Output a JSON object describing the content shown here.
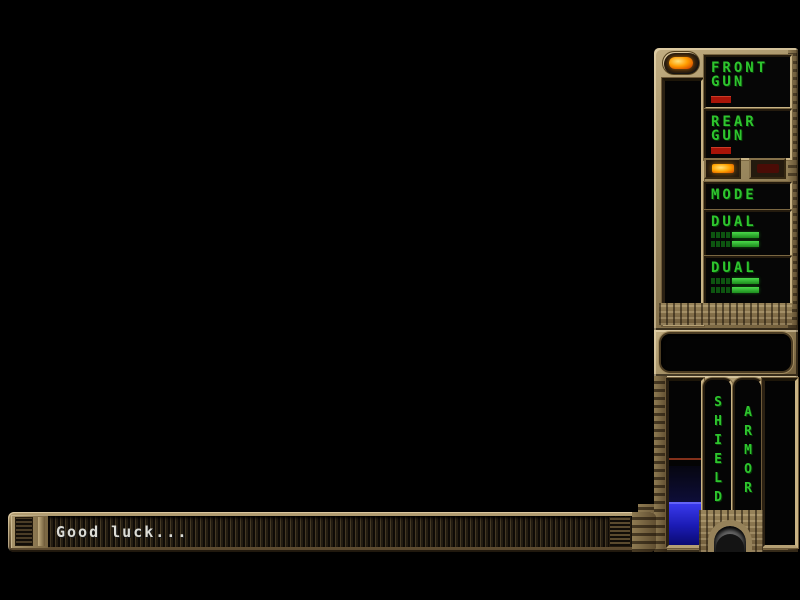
{
  "window": {
    "width": 800,
    "height": 600
  },
  "sidebar": {
    "weapon_panel": {
      "power_led": "on",
      "energy_fill_pct": 8,
      "front_gun": {
        "line1": "FRONT",
        "line2": "GUN",
        "power_pct": 24
      },
      "rear_gun": {
        "line1": "REAR",
        "line2": "GUN",
        "power_pct": 24
      },
      "mode": {
        "label": "MODE",
        "left_light": "on",
        "right_light": "off"
      },
      "dual_top": {
        "label": "DUAL",
        "dim_segments": 4,
        "bar_px": 27
      },
      "dual_bottom": {
        "label": "DUAL",
        "dim_segments": 4,
        "bar_px": 27
      }
    },
    "status_panel": {
      "shield": {
        "label": "SHIELD",
        "fill_pct": 26,
        "marker_pct": 47
      },
      "armor": {
        "label": "ARMOR",
        "fill_pct": 0
      }
    },
    "colors": {
      "metal": "#9c895f",
      "metal_light": "#c9b486",
      "metal_dark": "#4e3e26",
      "text_green": "#2ec52e",
      "bar_red": "#a81408",
      "shield_blue": "#2424d8",
      "led_orange": "#ff9d00",
      "unlit_maroon": "#4a0c06"
    }
  },
  "message_bar": {
    "text": "Good luck..."
  }
}
